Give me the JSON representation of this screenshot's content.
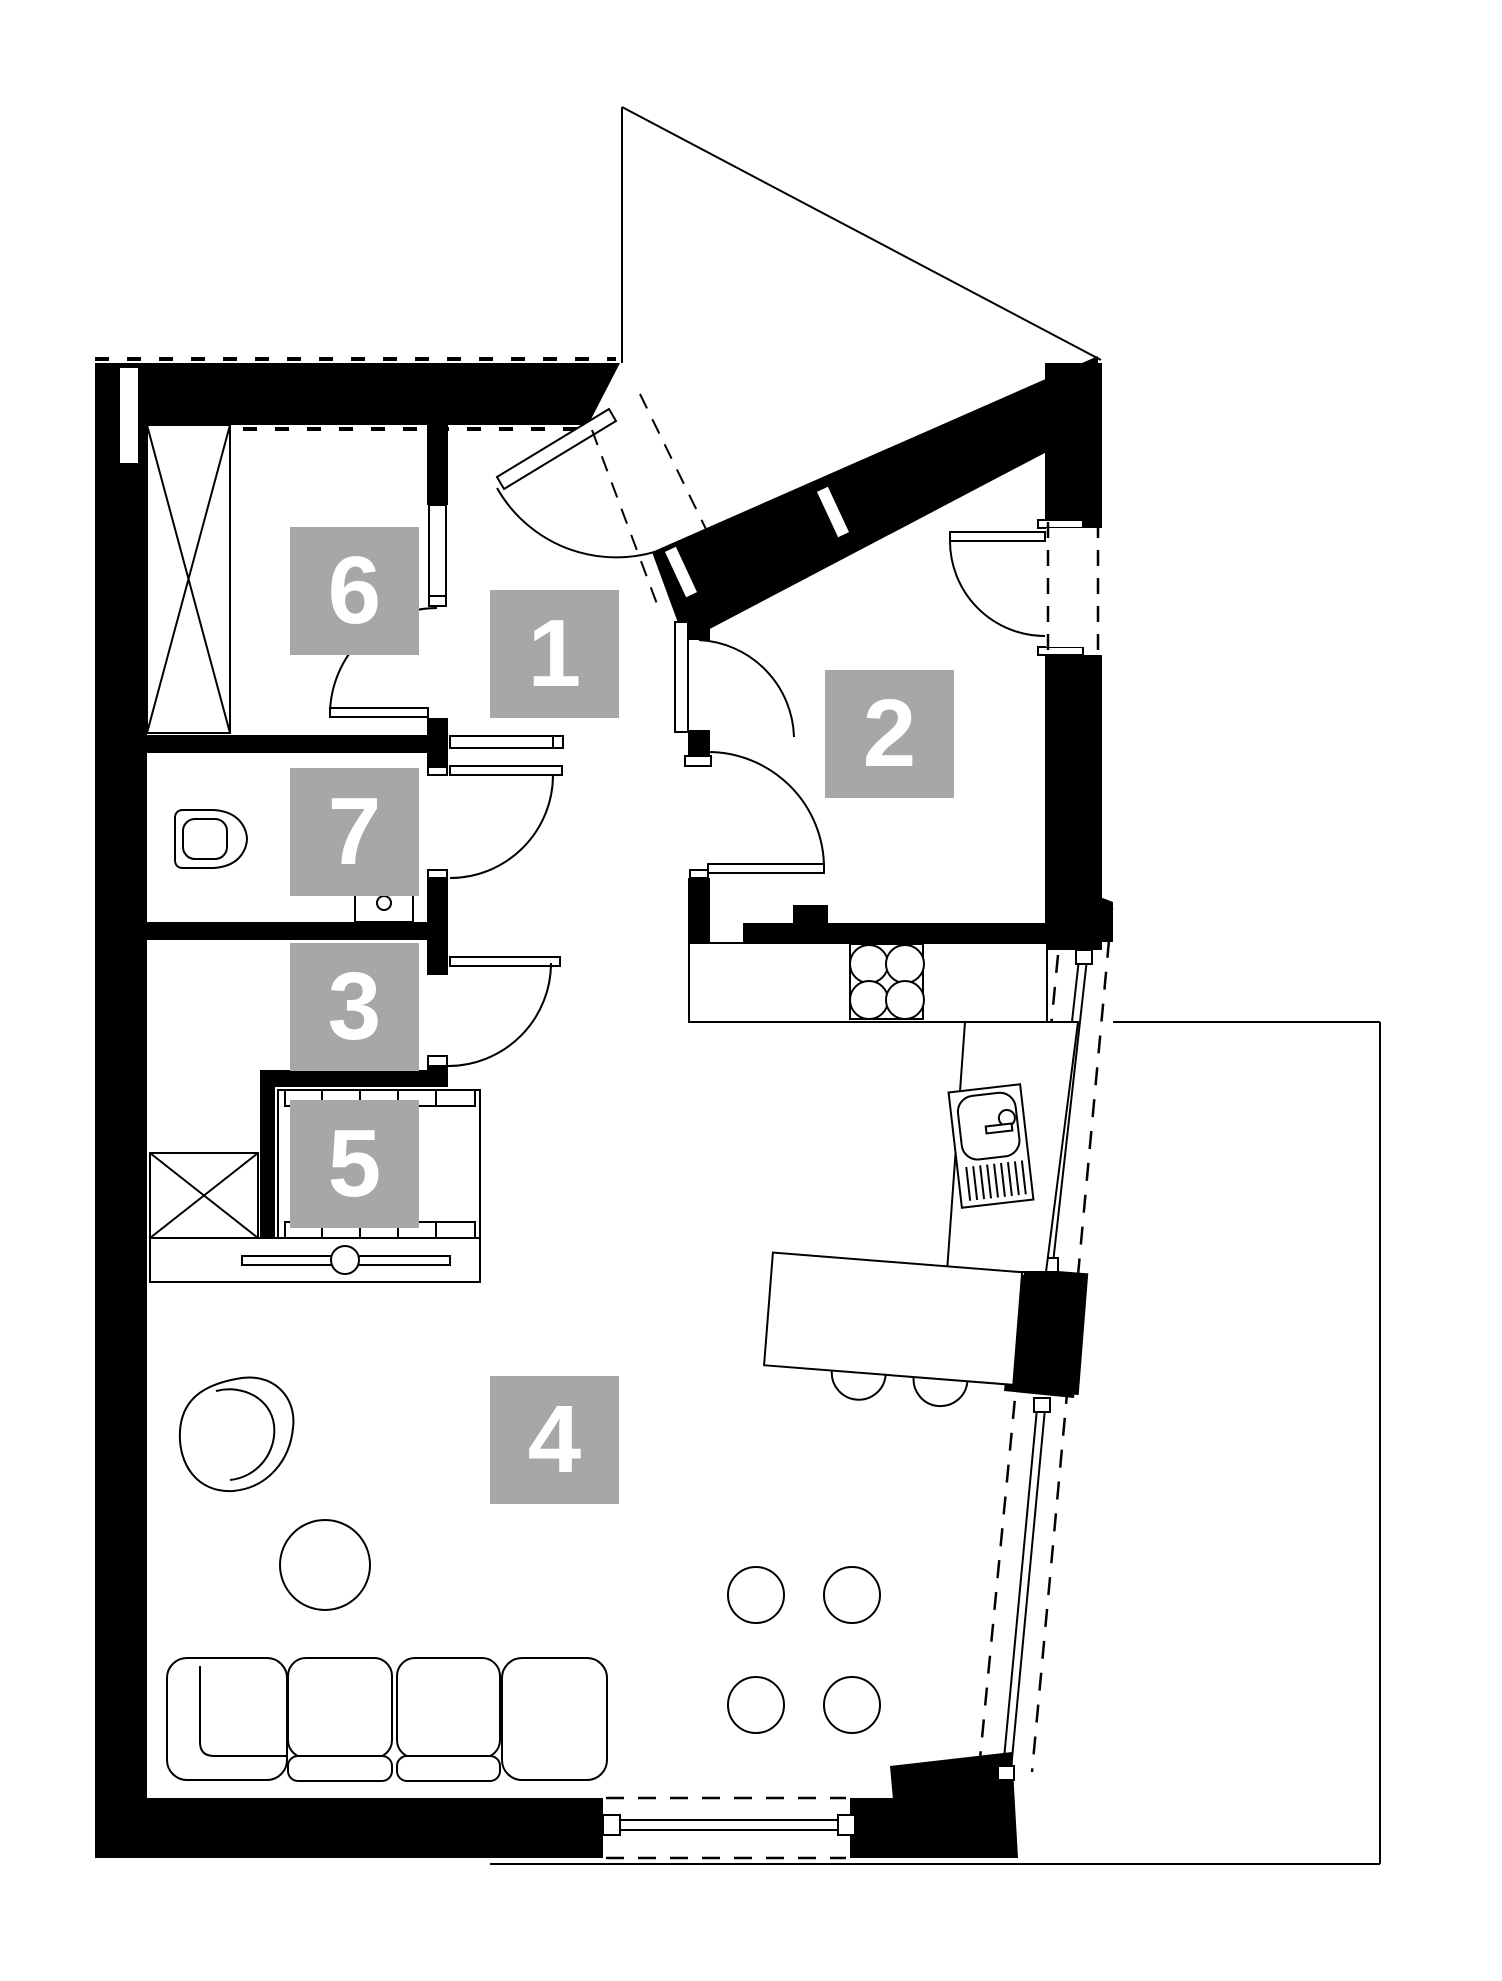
{
  "document": {
    "kind": "apartment floor plan drawing",
    "background": "#ffffff"
  },
  "colors": {
    "wall_fill": "#000000",
    "line": "#000000",
    "label_background": "#a7a7a7",
    "label_text": "#ffffff"
  },
  "room_labels": [
    {
      "label": "1"
    },
    {
      "label": "2"
    },
    {
      "label": "3"
    },
    {
      "label": "4"
    },
    {
      "label": "5"
    },
    {
      "label": "6"
    },
    {
      "label": "7"
    }
  ],
  "symbols": [
    "entry-door-swing",
    "interior-door-swing",
    "sliding-glass-door",
    "window-dashed",
    "wardrobe-cross",
    "shaft-cross",
    "toilet",
    "washbasin",
    "kitchen-sink",
    "stove-4-burners",
    "kitchen-island",
    "bar-stool",
    "sofa",
    "armchair",
    "round-table",
    "pouf",
    "terrace-outline"
  ]
}
